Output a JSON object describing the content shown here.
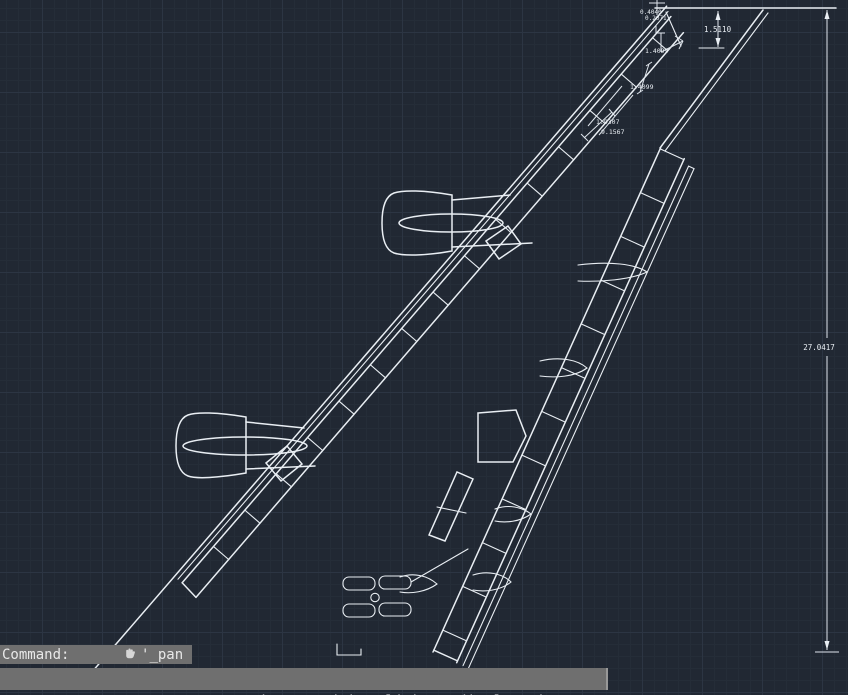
{
  "app": {
    "kind": "cad-drawing-viewport",
    "subject": "swept aircraft wing planform with two engine nacelles, slat and flap bands, flap-track fairings and linear dimensions"
  },
  "colors": {
    "background": "#212833",
    "grid_minor": "#252d38",
    "grid_major": "#2c3543",
    "drawing_line": "#e9eef3",
    "overlay_bar_bg": "#6f6f6f",
    "overlay_bar_text": "#f1f1f1"
  },
  "drawing": {
    "dim_labels": {
      "tip_a": "0.4040",
      "tip_b": "0.2071",
      "tip_chord": "1.5110",
      "slat_outer": "1.4099",
      "slat_inner": "1.4099",
      "le_break": "1.9307",
      "le_outer_span": "9.1567",
      "semi_span": "27.0417"
    }
  },
  "command_line": {
    "prompt": "Command:",
    "command": "'_pan",
    "icon": "pan-hand-icon"
  },
  "status_bar": {
    "message": "Press ESC or ENTER to exit, or right-click to display shortcut menu."
  }
}
